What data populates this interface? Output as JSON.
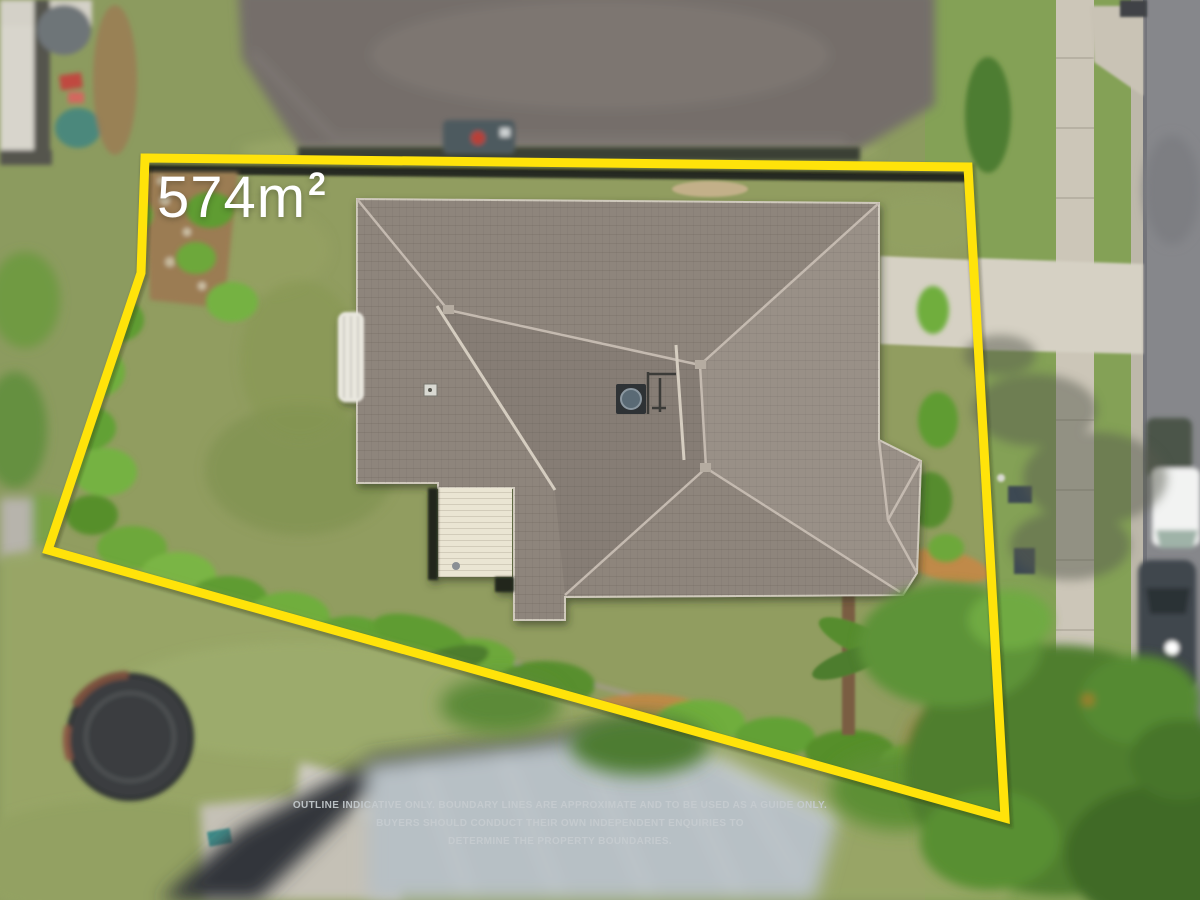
{
  "annotation": {
    "area_value": "574m",
    "area_superscript": "2",
    "disclaimer_lines": [
      "OUTLINE INDICATIVE ONLY. BOUNDARY LINES ARE APPROXIMATE AND TO BE USED AS A GUIDE ONLY.",
      "BUYERS SHOULD CONDUCT THEIR OWN INDEPENDENT ENQUIRIES TO",
      "DETERMINE THE PROPERTY BOUNDARIES."
    ]
  },
  "colors": {
    "boundary_yellow": "#ffe30a",
    "area_label_white": "#ffffff",
    "disclaimer_gray": "#c6ccd0",
    "lawn_green": "#8c9b5f",
    "nature_strip_green": "#84a156",
    "main_roof_gray": "#8e857c",
    "roof_ridge": "#c4bab0",
    "neighbor_roof": "#746e6a",
    "bottom_roof_blue_gray": "#b7c0c5",
    "garage_door_cream": "#eae5d3",
    "road_gray": "#86878b",
    "footpath_concrete": "#ccc6b8",
    "driveway_concrete": "#d6d1c4",
    "tree_green": "#4f7e2f",
    "trampoline_dark": "#3b3d3f"
  }
}
